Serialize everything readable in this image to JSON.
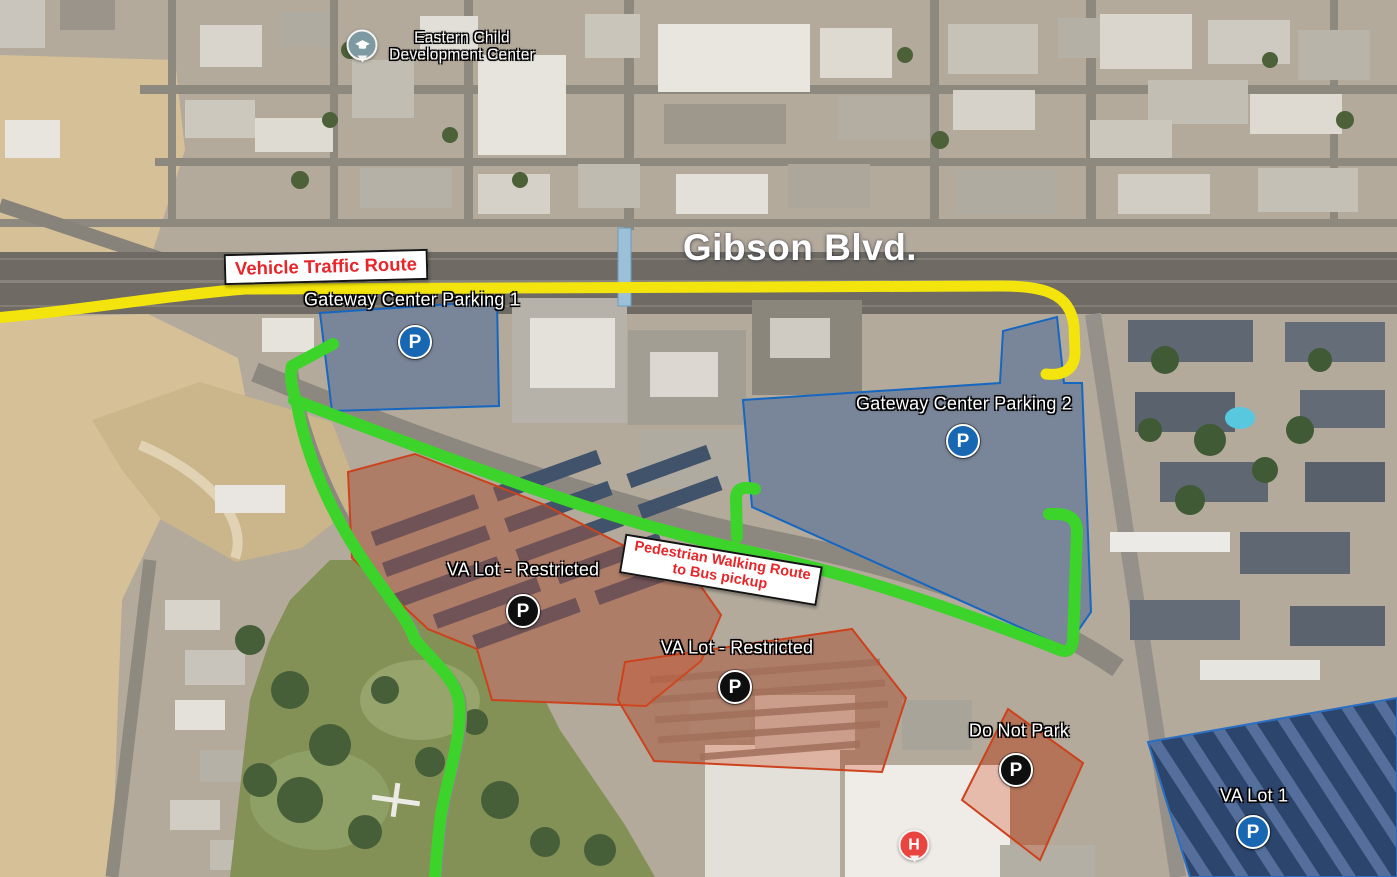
{
  "map": {
    "street": {
      "name": "Gibson Blvd."
    },
    "poi_school": {
      "name_line1": "Eastern Child",
      "name_line2": "Development Center",
      "icon": "school-pin"
    },
    "route_annotations": {
      "vehicle": {
        "label": "Vehicle Traffic Route",
        "color": "#F2E40C"
      },
      "pedestrian": {
        "label_line1": "Pedestrian Walking Route",
        "label_line2": "to Bus pickup",
        "color": "#3CD32B"
      }
    },
    "parking_areas": [
      {
        "label": "Gateway Center Parking 1",
        "marker": "P",
        "access": "public",
        "marker_color": "#1767B2"
      },
      {
        "label": "Gateway Center Parking 2",
        "marker": "P",
        "access": "public",
        "marker_color": "#1767B2"
      },
      {
        "label": "VA Lot - Restricted",
        "marker": "P",
        "access": "restricted",
        "marker_color": "#0E0E0E"
      },
      {
        "label": "VA Lot - Restricted",
        "marker": "P",
        "access": "restricted",
        "marker_color": "#0E0E0E"
      },
      {
        "label": "Do Not Park",
        "marker": "P",
        "access": "restricted",
        "marker_color": "#0E0E0E"
      },
      {
        "label": "VA Lot 1",
        "marker": "P",
        "access": "public",
        "marker_color": "#1767B2"
      }
    ],
    "hospital_helipad": {
      "marker": "H",
      "color": "#EA4440"
    },
    "overlay_colors": {
      "public_parking_fill": "rgba(40,105,200,0.30)",
      "public_parking_stroke": "#1667C0",
      "restricted_fill": "rgba(210,85,45,0.32)",
      "restricted_stroke": "#CC421C"
    }
  }
}
